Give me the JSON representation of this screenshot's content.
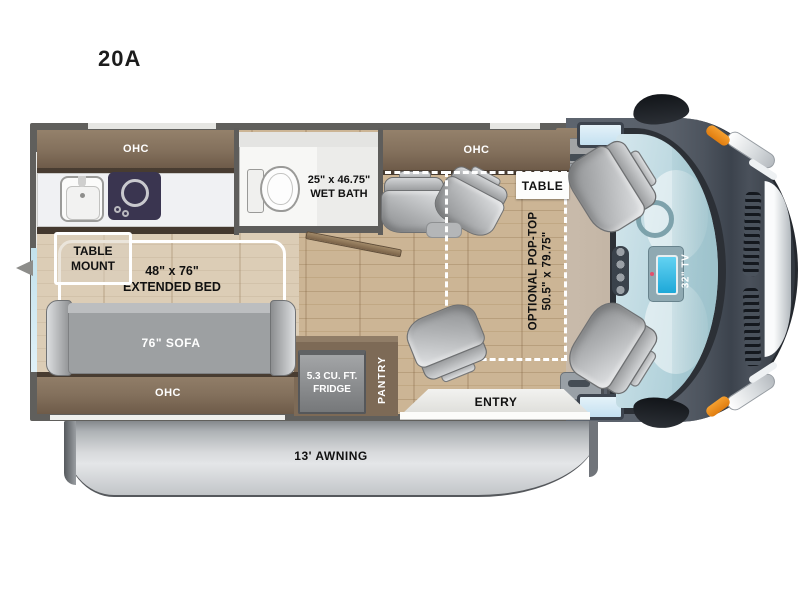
{
  "title": {
    "model": "20A"
  },
  "labels": {
    "kitchen_ohc": "OHC",
    "dinette_ohc": "OHC",
    "sofa_ohc": "OHC",
    "wet_bath_dims": "25\" x 46.75\"",
    "wet_bath_name": "WET BATH",
    "table": "TABLE",
    "table_mount_1": "TABLE",
    "table_mount_2": "MOUNT",
    "bed_dims": "48\" x 76\"",
    "bed_name": "EXTENDED BED",
    "sofa": "76\" SOFA",
    "pop_top_1": "OPTIONAL POP-TOP",
    "pop_top_2": "50.5\" x 79.75\"",
    "fridge_1": "5.3 CU. FT.",
    "fridge_2": "FRIDGE",
    "pantry": "PANTRY",
    "entry": "ENTRY",
    "awning": "13' AWNING",
    "tv": "32\" TV"
  },
  "colors": {
    "wall": "#605f5c",
    "wood_floor": "#c9b191",
    "bed_floor": "#dccdb6",
    "cabinet_brown": "#83705c",
    "sofa_gray": "#9da0a2",
    "cab_body": "#59606a",
    "windshield_blue": "#bcd8e0",
    "marker_orange": "#ee8c1c",
    "pop_top_dash": "#ffffff",
    "cooktop_navy": "#3a3550"
  }
}
